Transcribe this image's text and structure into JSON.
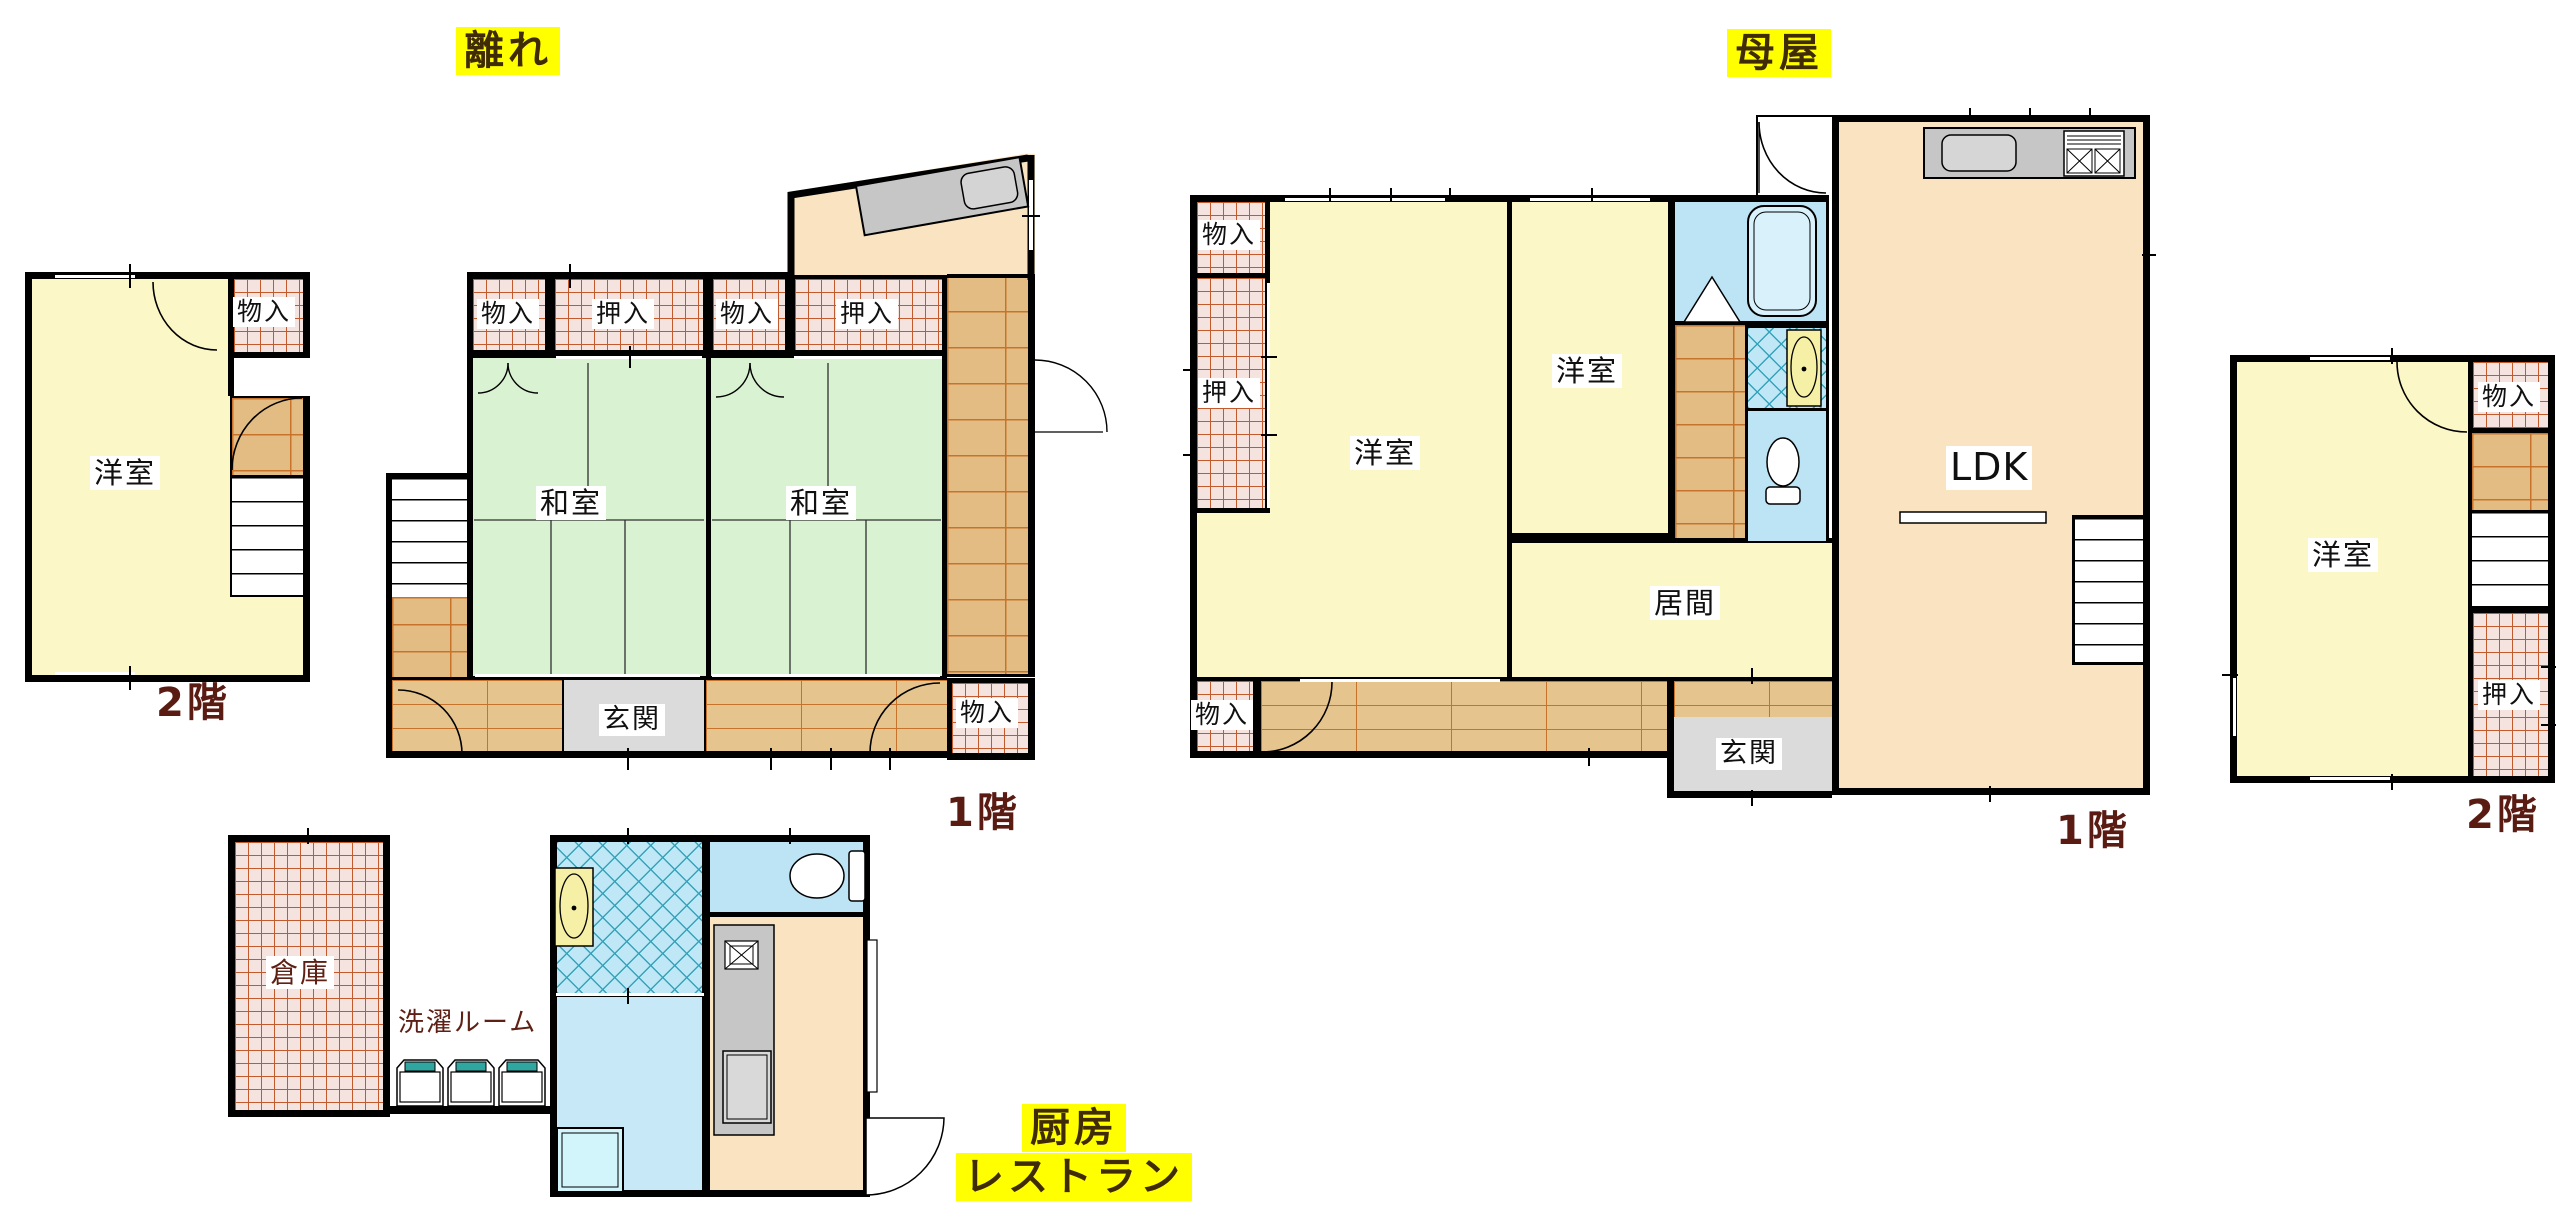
{
  "t": {
    "hanare": "離れ",
    "omoya": "母屋",
    "f1": "1階",
    "f2": "2階",
    "yoshitsu": "洋室",
    "washitsu": "和室",
    "monoiri": "物入",
    "oshiire": "押入",
    "genkan": "玄関",
    "ima": "居間",
    "ldk": "LDK",
    "souko": "倉庫",
    "sentaku": "洗濯ルーム",
    "chubo": "厨房",
    "resutoran": "レストラン"
  },
  "structure": {
    "type": "floor-plan",
    "buildings": [
      {
        "id": "hanare",
        "title": "離れ",
        "floors": [
          {
            "name": "2階",
            "rooms": [
              "洋室",
              "物入"
            ]
          },
          {
            "name": "1階",
            "rooms": [
              "和室",
              "和室",
              "物入",
              "押入",
              "物入",
              "押入",
              "玄関",
              "物入"
            ]
          }
        ]
      },
      {
        "id": "omoya",
        "title": "母屋",
        "floors": [
          {
            "name": "1階",
            "rooms": [
              "洋室",
              "洋室",
              "LDK",
              "居間",
              "玄関",
              "物入",
              "押入",
              "物入"
            ]
          },
          {
            "name": "2階",
            "rooms": [
              "洋室",
              "物入",
              "押入"
            ]
          }
        ]
      },
      {
        "id": "annex",
        "labels": [
          "厨房",
          "レストラン"
        ],
        "rooms": [
          "倉庫",
          "洗濯ルーム"
        ]
      }
    ]
  },
  "colors": {
    "highlight": "#FFFF00",
    "floor_label_text": "#5A1B12",
    "room_yellow": "#FCF7C6",
    "room_peach": "#F9E3C1",
    "tatami_green": "#D9F2D1",
    "bath_blue": "#BCE4F4",
    "closet_hatch_line": "#C25A2E",
    "wood_line": "#C8732C",
    "entrance_gray": "#DBDBDB",
    "wall": "#000000"
  }
}
